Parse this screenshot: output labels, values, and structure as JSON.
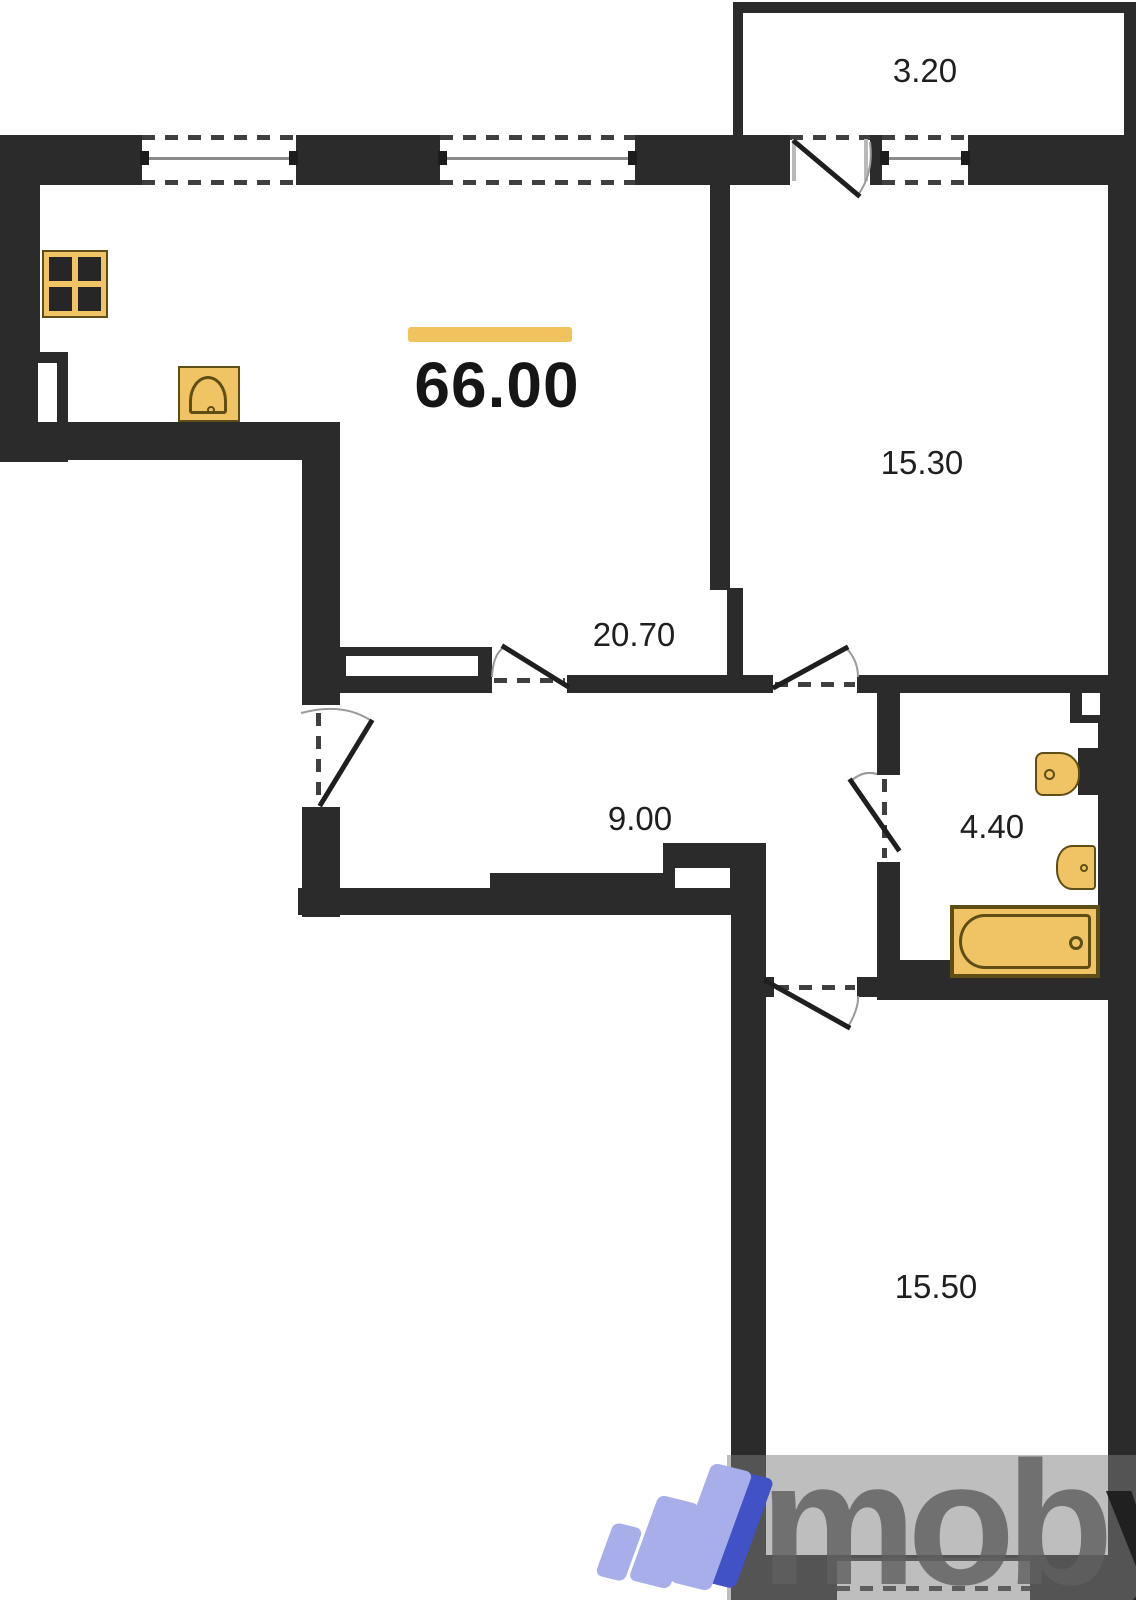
{
  "title": "Apartment floor plan",
  "summary": {
    "total_area": "66.00"
  },
  "rooms": {
    "balcony": {
      "label": "3.20"
    },
    "bedroom_top": {
      "label": "15.30"
    },
    "living_kitchen": {
      "label": "20.70"
    },
    "hallway": {
      "label": "9.00"
    },
    "bathroom": {
      "label": "4.40"
    },
    "bedroom_bottom": {
      "label": "15.50"
    }
  },
  "watermark": {
    "word_main": "mob",
    "word_tail": "y"
  },
  "icons": [
    "stove-icon",
    "kitchen-sink-icon",
    "washbasin-icon",
    "toilet-icon",
    "bathtub-icon",
    "moby-logo-icon"
  ],
  "palette": {
    "wall": "#2b2b2b",
    "accent_bar": "#f0c35e",
    "fixture_fill": "#f0c464",
    "fixture_stroke": "#5f4d16",
    "logo_light": "#a7aeea",
    "logo_dark": "#4052c5",
    "label_color": "#1f1f1f"
  }
}
